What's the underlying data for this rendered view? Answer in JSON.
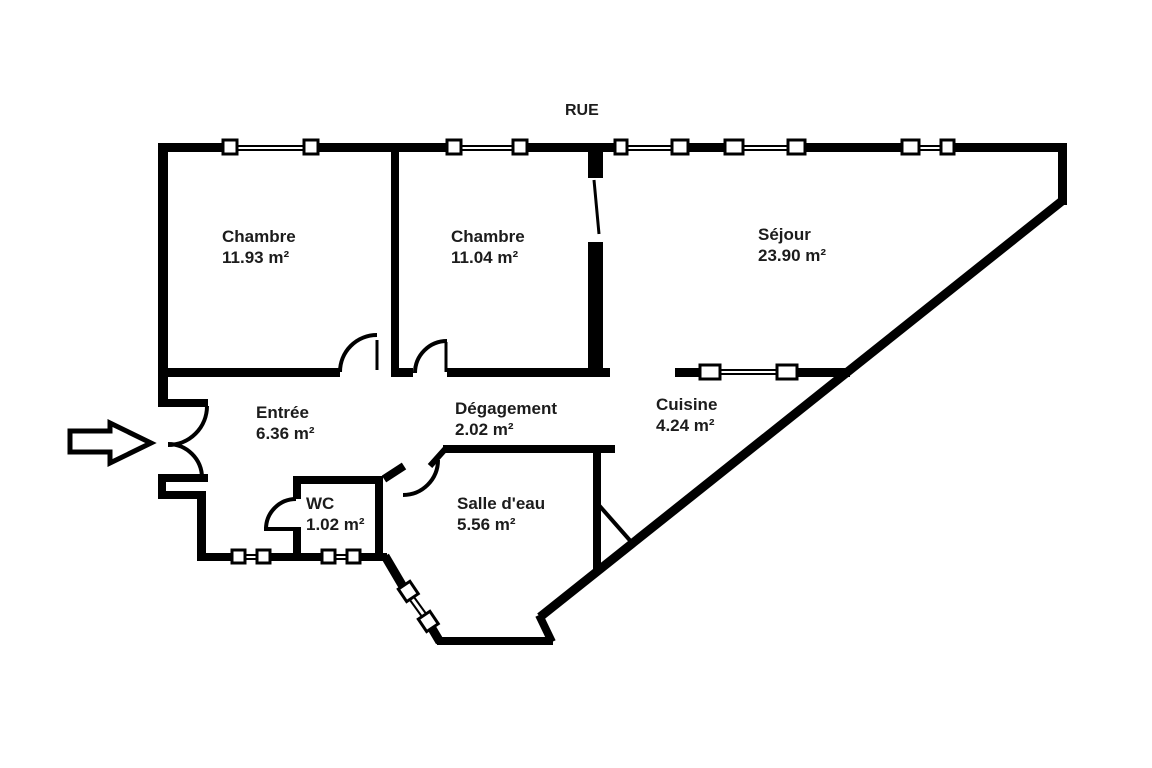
{
  "plan": {
    "street_label": "RUE",
    "rooms": [
      {
        "name": "Chambre",
        "area": "11.93 m²"
      },
      {
        "name": "Chambre",
        "area": "11.04 m²"
      },
      {
        "name": "Séjour",
        "area": "23.90 m²"
      },
      {
        "name": "Entrée",
        "area": "6.36 m²"
      },
      {
        "name": "Dégagement",
        "area": "2.02 m²"
      },
      {
        "name": "Cuisine",
        "area": "4.24 m²"
      },
      {
        "name": "WC",
        "area": "1.02 m²"
      },
      {
        "name": "Salle d'eau",
        "area": "5.56 m²"
      }
    ],
    "colors": {
      "wall": "#000000",
      "background": "#ffffff",
      "text": "#1c1c1c"
    }
  }
}
